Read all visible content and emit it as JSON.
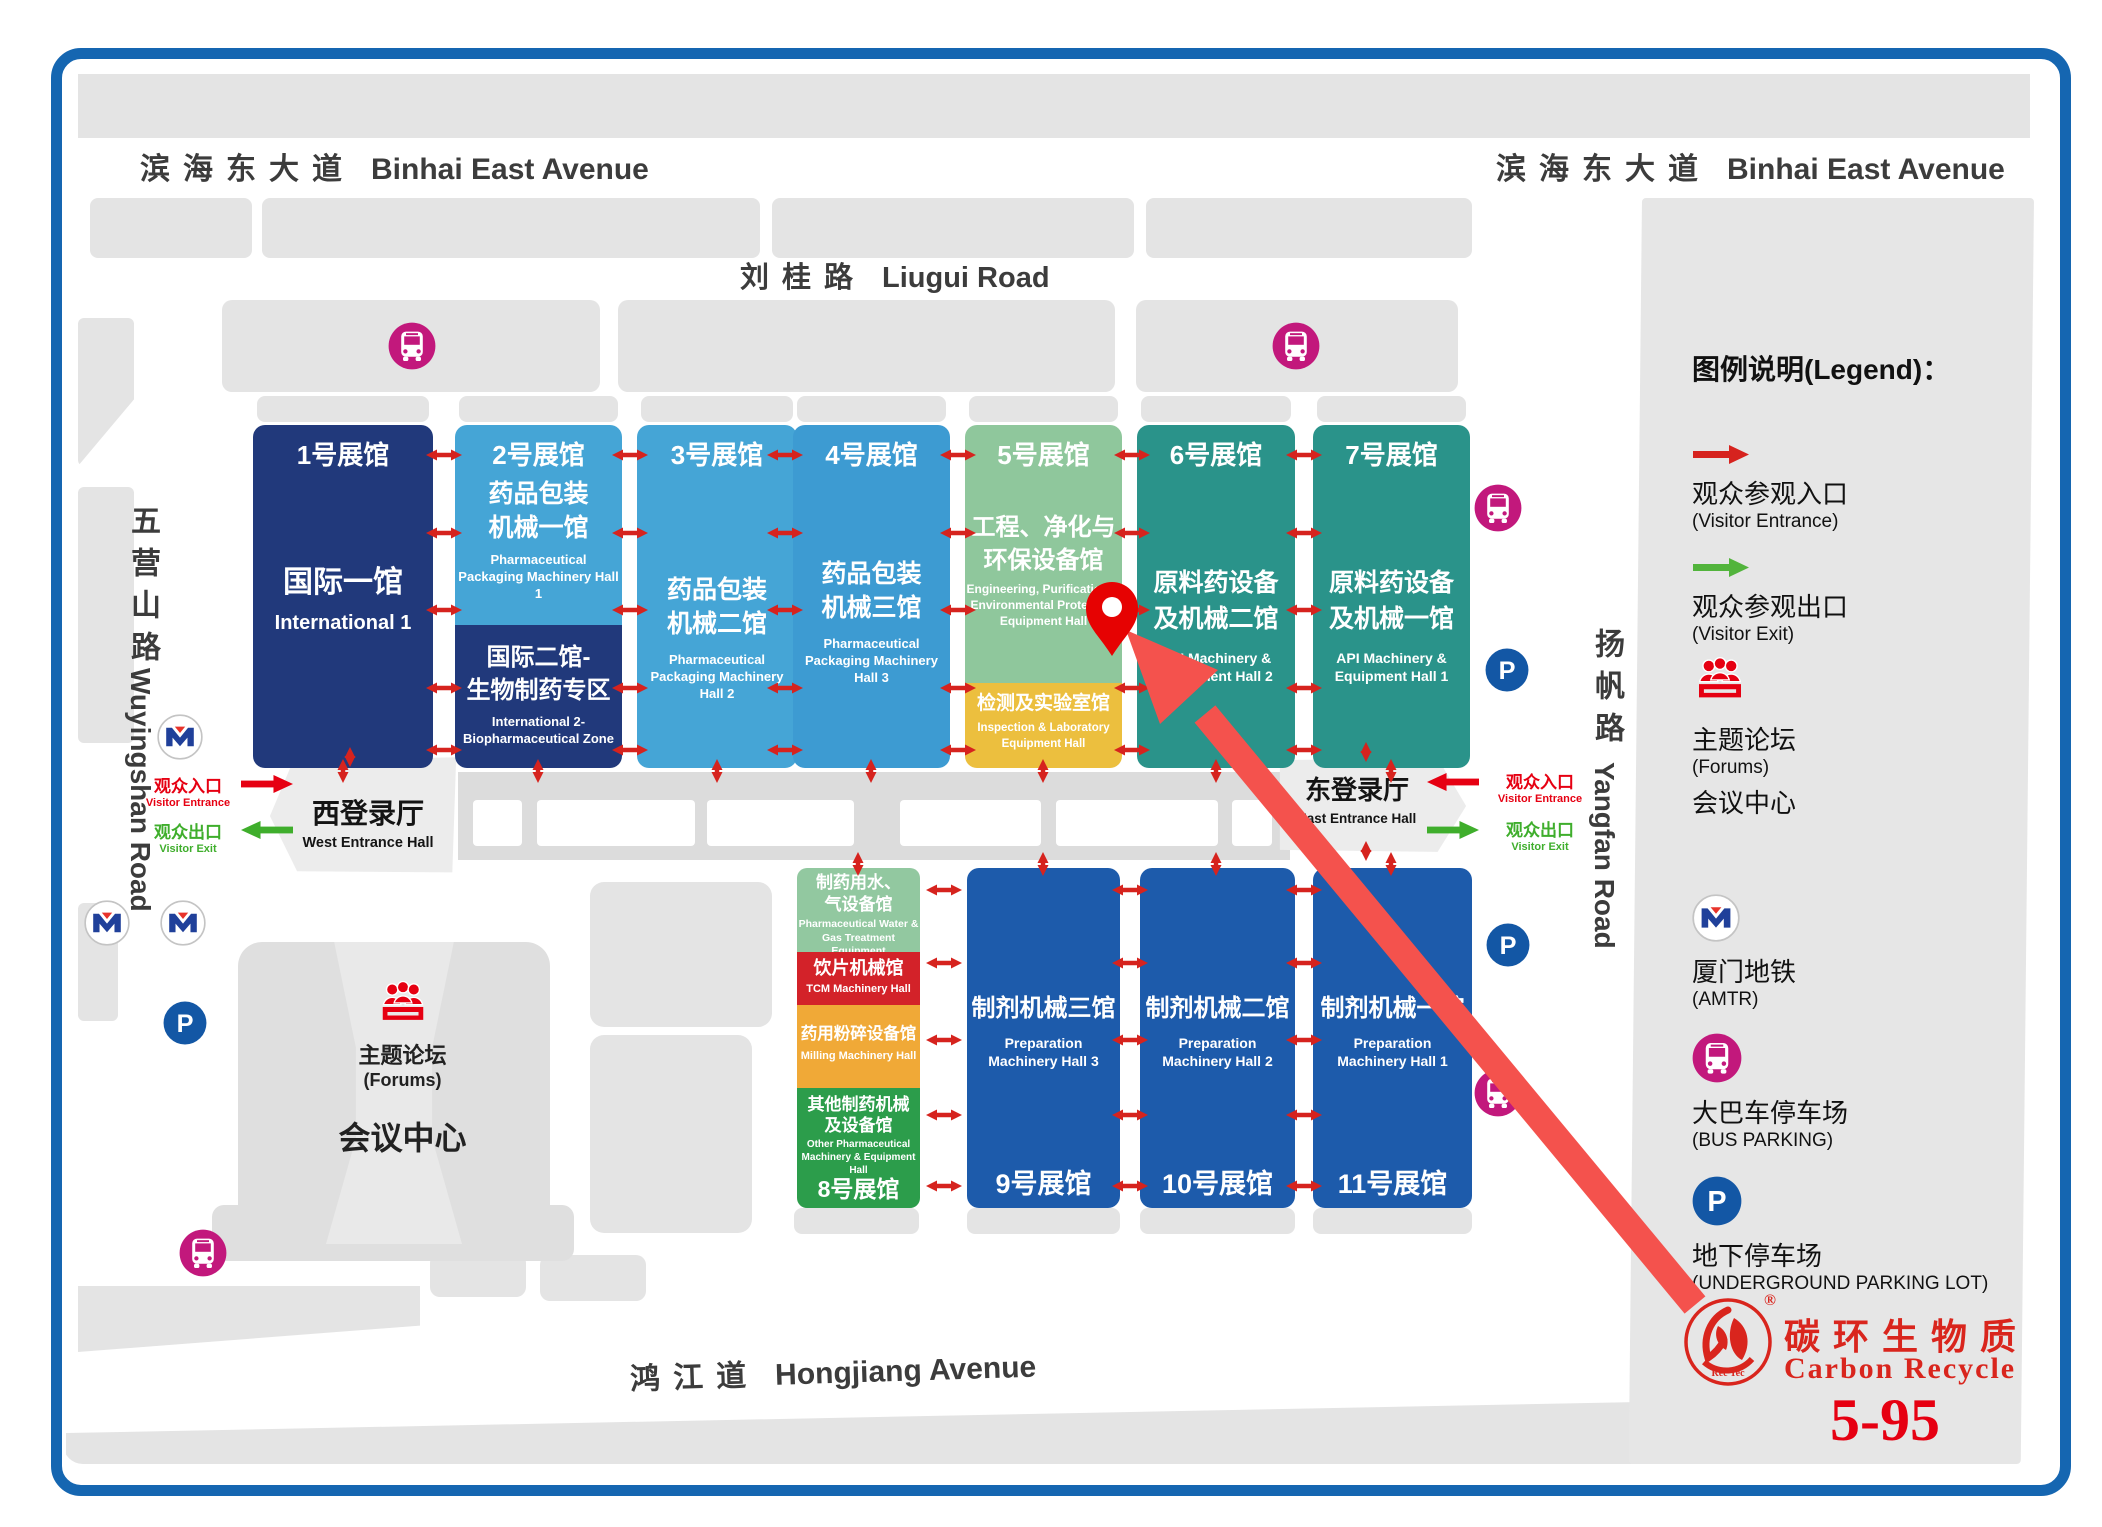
{
  "page": {
    "legend_title": "图例说明(Legend)：",
    "booth": "5-95"
  },
  "brand": {
    "cn": "碳环生物质",
    "en": "Carbon Recycle",
    "mark": "®",
    "logo_small": "Rec Tec"
  },
  "roads": {
    "binhai": {
      "cn": "滨海东大道",
      "en": "Binhai East Avenue"
    },
    "liugui": {
      "cn": "刘桂路",
      "en": "Liugui Road"
    },
    "hongjiang": {
      "cn": "鸿江道",
      "en": "Hongjiang Avenue"
    },
    "wuyingshan": {
      "cn": "五营山路",
      "en": "Wuyingshan Road"
    },
    "yangfan": {
      "cn": "扬帆路",
      "en": "Yangfan Road"
    }
  },
  "entrances": {
    "west": {
      "hall_cn": "西登录厅",
      "hall_en": "West Entrance Hall",
      "in_cn": "观众入口",
      "in_en": "Visitor Entrance",
      "out_cn": "观众出口",
      "out_en": "Visitor Exit"
    },
    "east": {
      "hall_cn": "东登录厅",
      "hall_en": "East Entrance Hall",
      "in_cn": "观众入口",
      "in_en": "Visitor Entrance",
      "out_cn": "观众出口",
      "out_en": "Visitor Exit"
    }
  },
  "forum_area": {
    "cn": "主题论坛",
    "en": "(Forums)",
    "center_cn": "会议中心"
  },
  "halls": [
    {
      "id": "hall-1",
      "num": "1号展馆",
      "cn": [
        "国际一馆"
      ],
      "en": [
        "International 1"
      ],
      "color": "#21397b"
    },
    {
      "id": "hall-2",
      "num": "2号展馆",
      "cn": [
        "药品包装",
        "机械一馆"
      ],
      "en": [
        "Pharmaceutical",
        "Packaging Machinery Hall 1"
      ],
      "color": "#45a5d6",
      "sub": {
        "cn": [
          "国际二馆-",
          "生物制药专区"
        ],
        "en": [
          "International 2-",
          "Biopharmaceutical Zone"
        ],
        "color": "#21397b"
      }
    },
    {
      "id": "hall-3",
      "num": "3号展馆",
      "cn": [
        "药品包装",
        "机械二馆"
      ],
      "en": [
        "Pharmaceutical",
        "Packaging Machinery Hall 2"
      ],
      "color": "#45a5d6"
    },
    {
      "id": "hall-4",
      "num": "4号展馆",
      "cn": [
        "药品包装",
        "机械三馆"
      ],
      "en": [
        "Pharmaceutical",
        "Packaging Machinery Hall 3"
      ],
      "color": "#3d9bd2"
    },
    {
      "id": "hall-5",
      "num": "5号展馆",
      "cn": [
        "工程、净化与",
        "环保设备馆"
      ],
      "en": [
        "Engineering, Purification &",
        "Environmental Protection",
        "Equipment Hall"
      ],
      "color": "#8fc79c",
      "sub": {
        "cn": [
          "检测及实验室馆"
        ],
        "en": [
          "Inspection & Laboratory",
          "Equipment Hall"
        ],
        "color": "#ecbf3e"
      }
    },
    {
      "id": "hall-6",
      "num": "6号展馆",
      "cn": [
        "原料药设备",
        "及机械二馆"
      ],
      "en": [
        "API Machinery &",
        "Equipment Hall 2"
      ],
      "color": "#2a938a"
    },
    {
      "id": "hall-7",
      "num": "7号展馆",
      "cn": [
        "原料药设备",
        "及机械一馆"
      ],
      "en": [
        "API Machinery &",
        "Equipment Hall 1"
      ],
      "color": "#2a938a"
    },
    {
      "id": "hall-8",
      "num": "8号展馆",
      "sections": [
        {
          "cn": [
            "制药用水、",
            "气设备馆"
          ],
          "en": [
            "Pharmaceutical Water &",
            "Gas Treatment Equipment"
          ],
          "color": "#92c8a0"
        },
        {
          "cn": [
            "饮片机械馆"
          ],
          "en": [
            "TCM Machinery Hall"
          ],
          "color": "#d32229"
        },
        {
          "cn": [
            "药用粉碎设备馆"
          ],
          "en": [
            "Milling Machinery Hall"
          ],
          "color": "#f0a937"
        },
        {
          "cn": [
            "其他制药机械",
            "及设备馆"
          ],
          "en": [
            "Other Pharmaceutical",
            "Machinery & Equipment Hall"
          ],
          "color": "#2c9d4b"
        }
      ]
    },
    {
      "id": "hall-9",
      "num": "9号展馆",
      "cn": [
        "制剂机械三馆"
      ],
      "en": [
        "Preparation",
        "Machinery Hall 3"
      ],
      "color": "#1d5bab"
    },
    {
      "id": "hall-10",
      "num": "10号展馆",
      "cn": [
        "制剂机械二馆"
      ],
      "en": [
        "Preparation",
        "Machinery Hall 2"
      ],
      "color": "#1d5bab"
    },
    {
      "id": "hall-11",
      "num": "11号展馆",
      "cn": [
        "制剂机械一馆"
      ],
      "en": [
        "Preparation",
        "Machinery Hall 1"
      ],
      "color": "#1d5bab"
    }
  ],
  "legend": [
    {
      "icon": "visitor-entrance-arrow-icon",
      "color": "#d6231e",
      "cn": "观众参观入口",
      "en": "(Visitor Entrance)"
    },
    {
      "icon": "visitor-exit-arrow-icon",
      "color": "#52b43c",
      "cn": "观众参观出口",
      "en": "(Visitor Exit)"
    },
    {
      "icon": "forum-icon",
      "color": "#e60012",
      "cn": "主题论坛",
      "en": "(Forums)",
      "extra": "会议中心"
    },
    {
      "icon": "metro-icon",
      "cn": "厦门地铁",
      "en": "(AMTR)"
    },
    {
      "icon": "bus-parking-icon",
      "color": "#c2187c",
      "cn": "大巴车停车场",
      "en": "(BUS PARKING)"
    },
    {
      "icon": "underground-parking-icon",
      "color": "#1357a5",
      "cn": "地下停车场",
      "en": "(UNDERGROUND PARKING LOT)"
    }
  ],
  "map_icons": [
    {
      "type": "bus-parking",
      "x": 412,
      "y": 346
    },
    {
      "type": "bus-parking",
      "x": 1296,
      "y": 346
    },
    {
      "type": "bus-parking",
      "x": 1498,
      "y": 508
    },
    {
      "type": "bus-parking",
      "x": 1498,
      "y": 1093
    },
    {
      "type": "bus-parking",
      "x": 203,
      "y": 1253
    },
    {
      "type": "metro",
      "x": 180,
      "y": 737
    },
    {
      "type": "metro",
      "x": 107,
      "y": 923
    },
    {
      "type": "metro",
      "x": 183,
      "y": 923
    },
    {
      "type": "underground-parking",
      "x": 185,
      "y": 1023
    },
    {
      "type": "underground-parking",
      "x": 1507,
      "y": 670
    },
    {
      "type": "underground-parking",
      "x": 1508,
      "y": 945
    }
  ],
  "booth_marker": {
    "pin_x": 1112,
    "pin_y": 622,
    "label": "5-95"
  }
}
